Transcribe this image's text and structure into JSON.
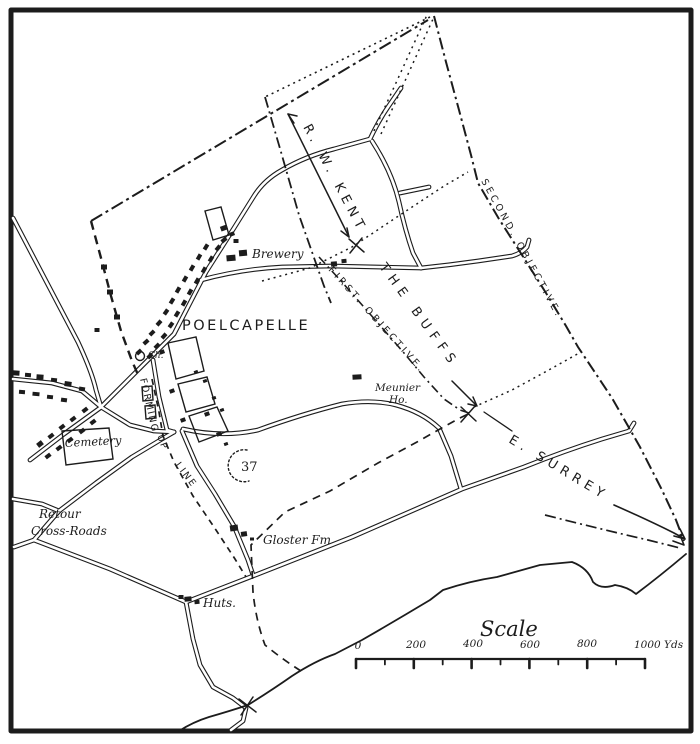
{
  "canvas": {
    "background": "#ffffff",
    "ink": "#1c1c1c"
  },
  "labels": {
    "town": "POELCAPELLE",
    "brewery": "Brewery",
    "church": "Ch.",
    "cemetery": "Cemetery",
    "retour_1": "Retour",
    "retour_2": "Cross-Roads",
    "meunier_1": "Meunier",
    "meunier_2": "Ho.",
    "hill": "37",
    "gloster": "Gloster Fm",
    "huts": "Huts.",
    "kent": "R. W. KENT",
    "buffs": "THE BUFFS",
    "surrey": "E. SURREY",
    "first_objective": "FIRST. OBJECTIVE.",
    "second_objective": "SECOND. OBJECTIVE.",
    "forming": "FORMING",
    "up": "UP",
    "line": "LINE"
  },
  "scale": {
    "title": "Scale",
    "ticks": [
      "0",
      "200",
      "400",
      "600",
      "800",
      "1000 Yds"
    ]
  }
}
